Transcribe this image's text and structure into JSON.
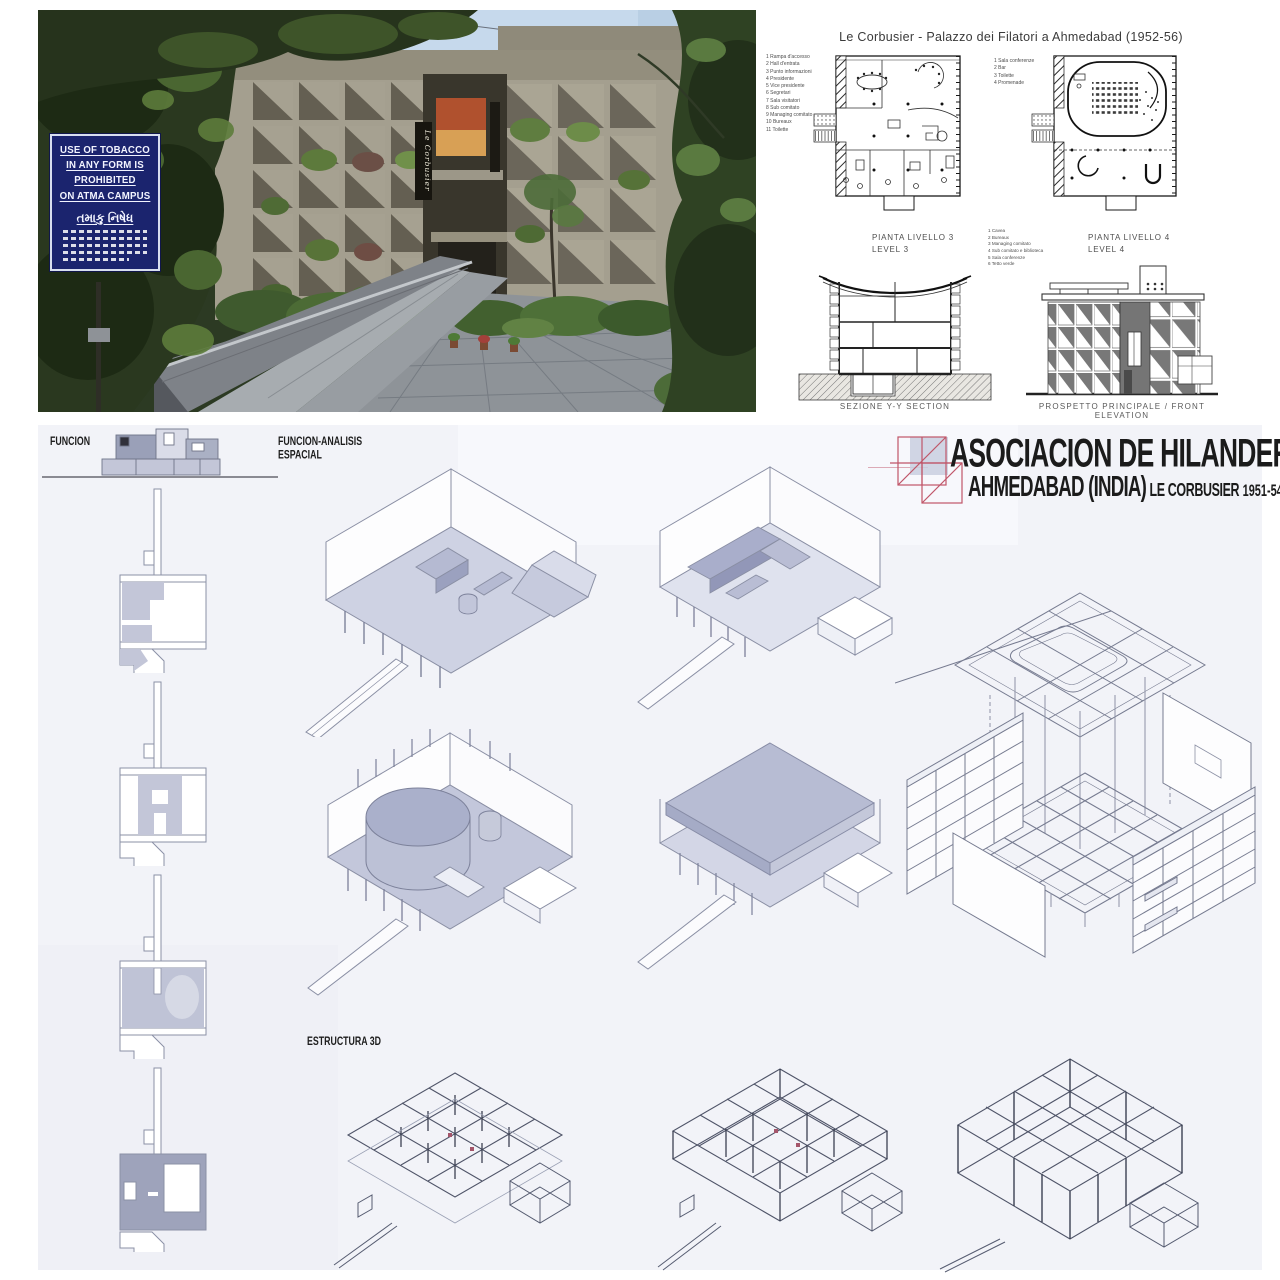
{
  "photo": {
    "sign": {
      "line1": "USE OF TOBACCO",
      "line2": "IN ANY FORM IS",
      "line3": "PROHIBITED",
      "line4": "ON ATMA CAMPUS",
      "gujarati_title": "તમાકુ નિષેધ"
    },
    "banner_text": "Le Corbusier"
  },
  "drawings": {
    "title": "Le Corbusier - Palazzo dei Filatori a Ahmedabad  (1952-56)",
    "legend_level3": [
      "1 Rampa d'accesso",
      "2 Hall d'entrata",
      "3 Punto informazioni",
      "4 Presidente",
      "5 Vice presidente",
      "6 Segretari",
      "7 Sala visitatori",
      "8 Sub comitato",
      "9 Managing comitato",
      "10 Bureaux",
      "11 Toilette"
    ],
    "legend_level4": [
      "1 Sala conferenze",
      "2 Bar",
      "3 Toilette",
      "4 Promenade"
    ],
    "legend_mid": [
      "1 Cavea",
      "2 Bureaux",
      "3 Managing comitato",
      "4 Sub comitato e biblioteca",
      "5 Sala conferenze",
      "6 Tetto verde"
    ],
    "plan3_label_it": "PIANTA LIVELLO 3",
    "plan3_label_en": "LEVEL 3",
    "plan4_label_it": "PIANTA LIVELLO 4",
    "plan4_label_en": "LEVEL 4",
    "section_label": "SEZIONE  Y-Y  SECTION",
    "elevation_label": "PROSPETTO PRINCIPALE  /  FRONT ELEVATION"
  },
  "board": {
    "label_funcion": "FUNCION",
    "label_funcion_analisis_1": "FUNCION-ANALISIS",
    "label_funcion_analisis_2": "ESPACIAL",
    "label_estructura": "ESTRUCTURA 3D",
    "title_line1": "ASOCIACION DE HILANDEROS",
    "title_line2_a": "AHMEDABAD  (INDIA)",
    "title_line2_b": "LE CORBUSIER",
    "title_line2_c": "1951-54"
  },
  "colors": {
    "sign_navy": "#1b246e",
    "board_bg": "#f2f3f8",
    "title_ink": "#1b1b1b",
    "logo_red": "#c05568",
    "axon_fill": "#ced2e3",
    "concrete": "#a49f8f",
    "sky": "#c6d9ec"
  }
}
